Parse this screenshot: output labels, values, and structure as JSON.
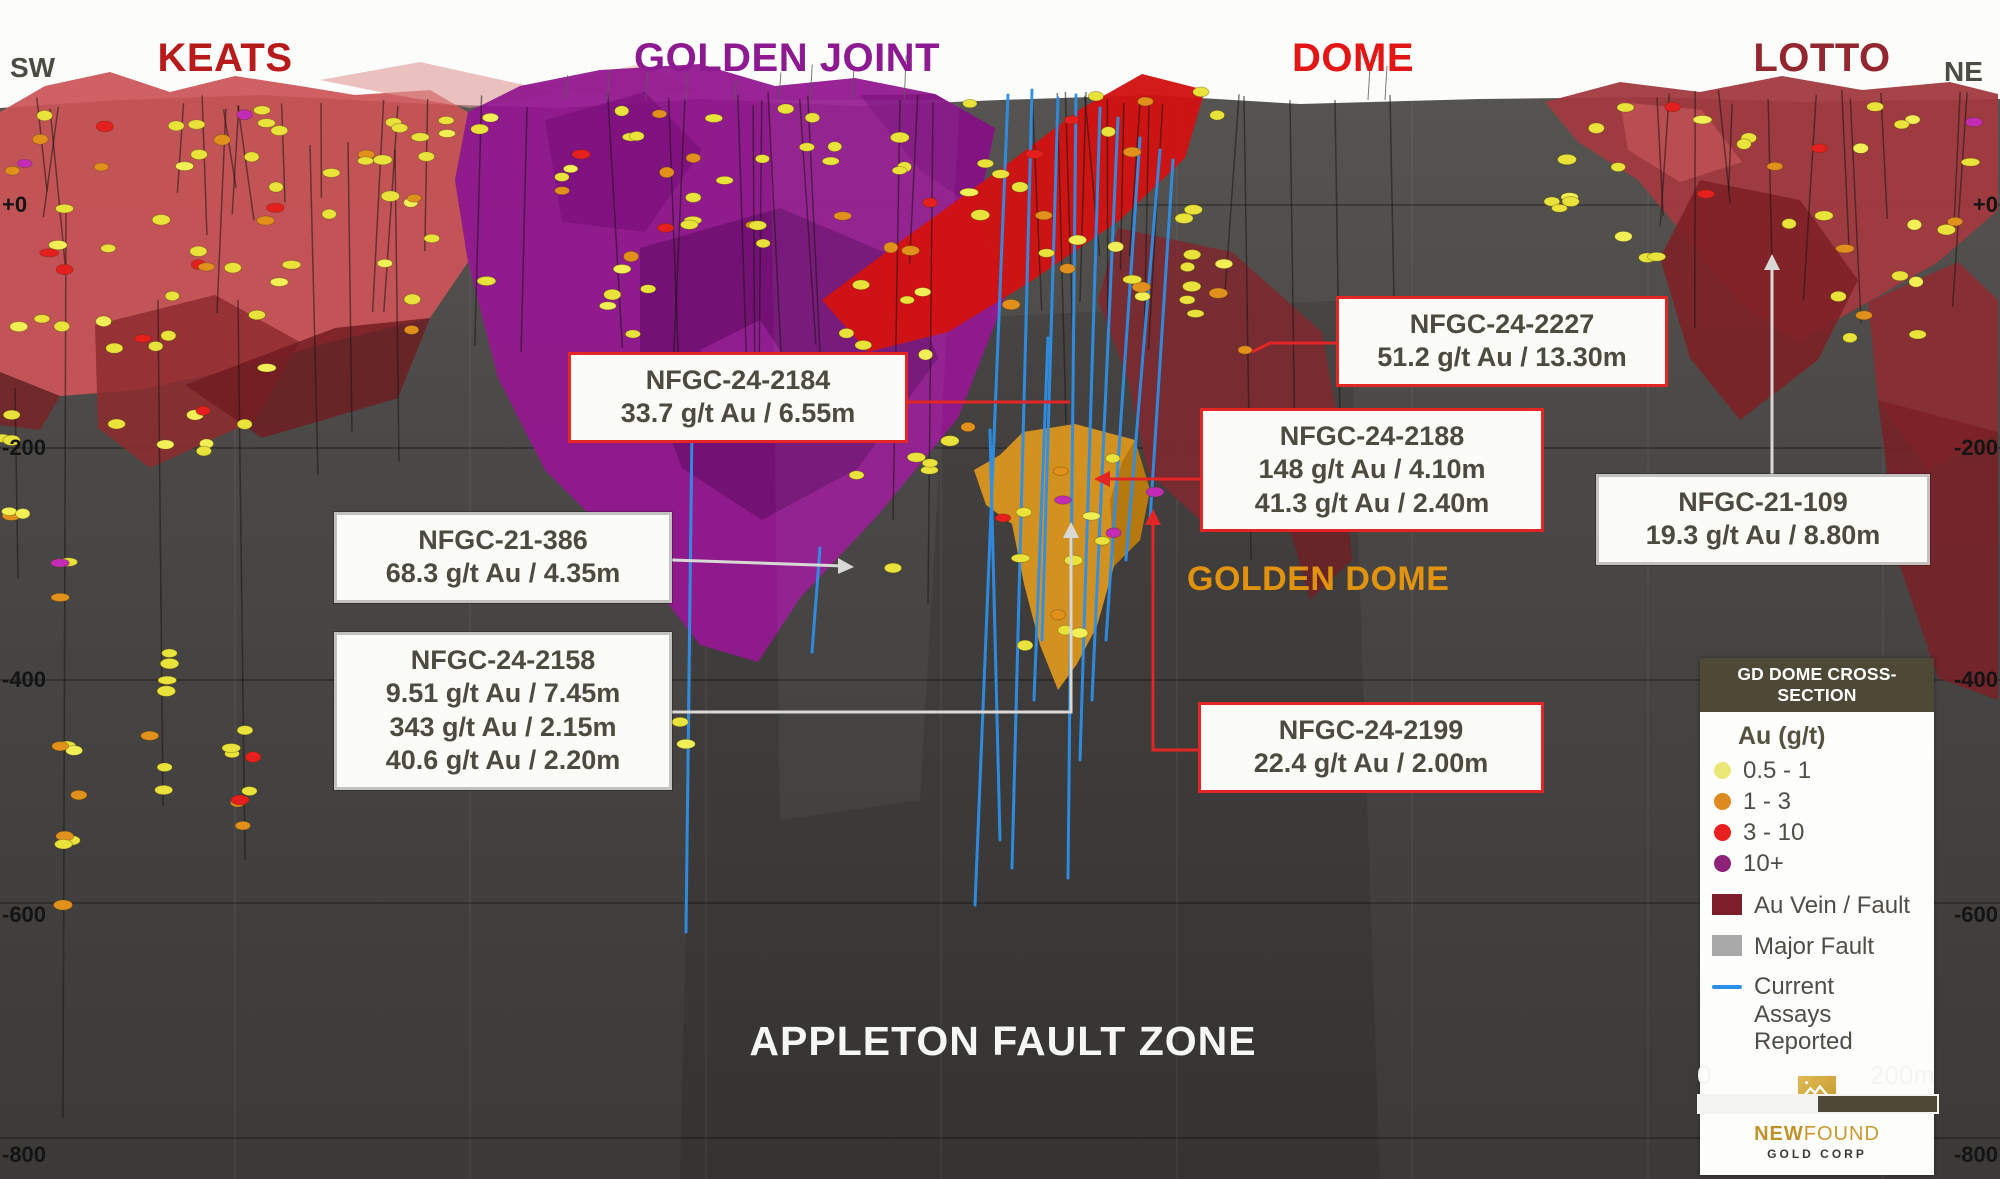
{
  "section": {
    "sw": "SW",
    "ne": "NE",
    "appleton_label": "APPLETON FAULT ZONE",
    "golden_dome_label": "GOLDEN DOME"
  },
  "zones": [
    {
      "label": "KEATS",
      "color": "#b81b1b"
    },
    {
      "label": "GOLDEN JOINT",
      "color": "#8d1a90"
    },
    {
      "label": "DOME",
      "color": "#e31616"
    },
    {
      "label": "LOTTO",
      "color": "#93262f"
    }
  ],
  "depths": [
    "+0",
    "-200",
    "-400",
    "-600",
    "-800"
  ],
  "callouts": [
    {
      "id": "NFGC-24-2184",
      "results": "33.7 g/t Au / 6.55m",
      "style": "red"
    },
    {
      "id": "NFGC-24-2227",
      "results": "51.2 g/t Au / 13.30m",
      "style": "red"
    },
    {
      "id": "NFGC-24-2188",
      "results": "148 g/t Au / 4.10m\n41.3 g/t Au / 2.40m",
      "style": "red"
    },
    {
      "id": "NFGC-21-386",
      "results": "68.3 g/t Au / 4.35m",
      "style": "gray"
    },
    {
      "id": "NFGC-21-109",
      "results": "19.3 g/t Au / 8.80m",
      "style": "gray"
    },
    {
      "id": "NFGC-24-2158",
      "results": "9.51 g/t Au / 7.45m\n343 g/t Au / 2.15m\n40.6 g/t Au / 2.20m",
      "style": "gray"
    },
    {
      "id": "NFGC-24-2199",
      "results": "22.4 g/t Au / 2.00m",
      "style": "red"
    }
  ],
  "legend": {
    "header": "GD DOME CROSS-SECTION",
    "au_title": "Au (g/t)",
    "au_classes": [
      {
        "label": "0.5 - 1",
        "color": "#ece878"
      },
      {
        "label": "1 - 3",
        "color": "#dd8b1f"
      },
      {
        "label": "3 - 10",
        "color": "#e8201f"
      },
      {
        "label": "10+",
        "color": "#8e2178"
      }
    ],
    "items": [
      {
        "label": "Au Vein / Fault",
        "color": "#7d1f2a"
      },
      {
        "label": "Major Fault",
        "color": "#a9a9a9"
      },
      {
        "label": "Current Assays Reported",
        "color": "#2e8fe8"
      }
    ]
  },
  "logo": {
    "name_bold": "NEW",
    "name_light": "FOUND",
    "sub": "GOLD CORP"
  },
  "scale_bar": {
    "start": "0",
    "end": "200m"
  }
}
